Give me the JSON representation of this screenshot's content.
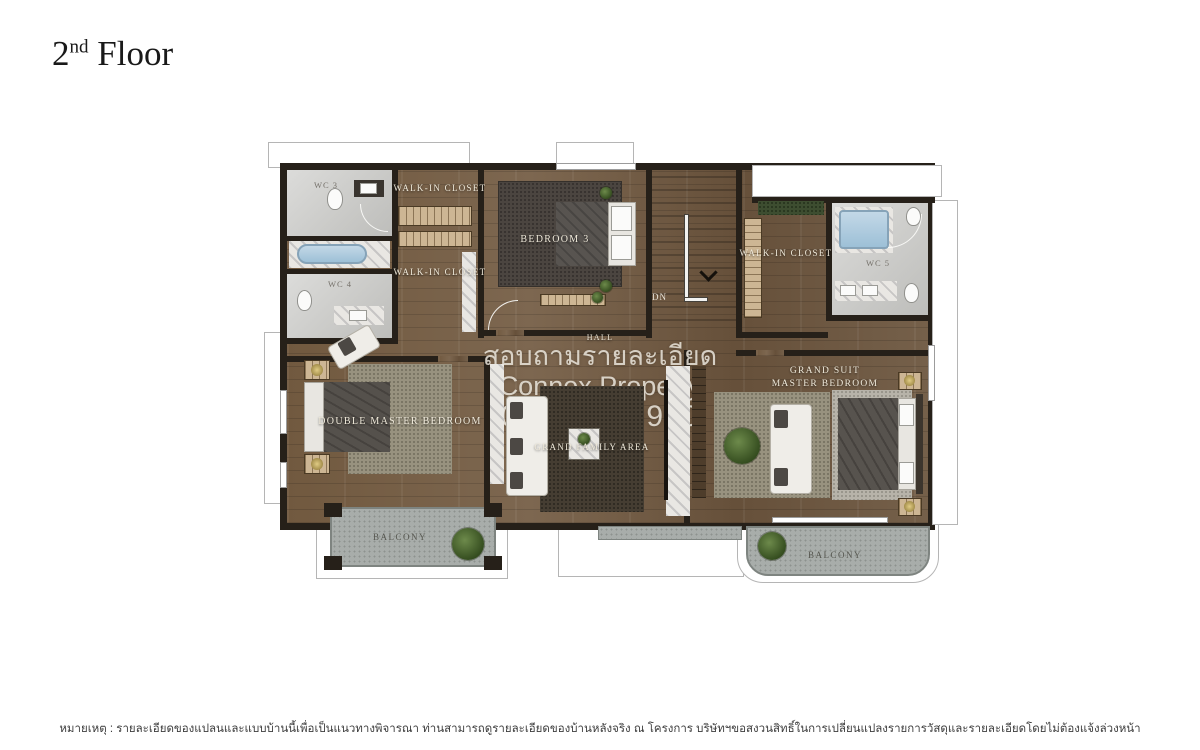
{
  "title": {
    "number": "2",
    "ordinal": "nd",
    "word": "Floor"
  },
  "labels": {
    "wc3": "WC 3",
    "wc4": "WC 4",
    "wc5": "WC 5",
    "closet1": "WALK-IN CLOSET",
    "closet2": "WALK-IN CLOSET",
    "closet3": "WALK-IN CLOSET",
    "bedroom3": "BEDROOM 3",
    "dn": "DN",
    "hall": "HALL",
    "double_master": "DOUBLE MASTER BEDROOM",
    "family": "GRAND FAMILY AREA",
    "suite_line1": "GRAND SUIT",
    "suite_line2": "MASTER BEDROOM",
    "balcony_left": "BALCONY",
    "balcony_right": "BALCONY"
  },
  "watermark": {
    "line1": "สอบถามรายละเอียด",
    "line2": "Connex Property",
    "line3": "099-019-9900"
  },
  "footer": {
    "note": "หมายเหตุ : รายละเอียดของแปลนและแบบบ้านนี้เพื่อเป็นแนวทางพิจารณา ท่านสามารถดูรายละเอียดของบ้านหลังจริง ณ โครงการ บริษัทฯขอสงวนสิทธิ์ในการเปลี่ยนแปลงรายการวัสดุและรายละเอียดโดยไม่ต้องแจ้งล่วงหน้า"
  },
  "palette": {
    "wood": "#6d5741",
    "wall": "#262019",
    "bathroom": "#c9c9c6",
    "tub_blue": "#a9c6db",
    "deck_gray": "#a8adaa",
    "closet_tan": "#cdb694",
    "watermark_text": "#ece7de",
    "title_text": "#191919",
    "note_text": "#3d3d3d"
  }
}
